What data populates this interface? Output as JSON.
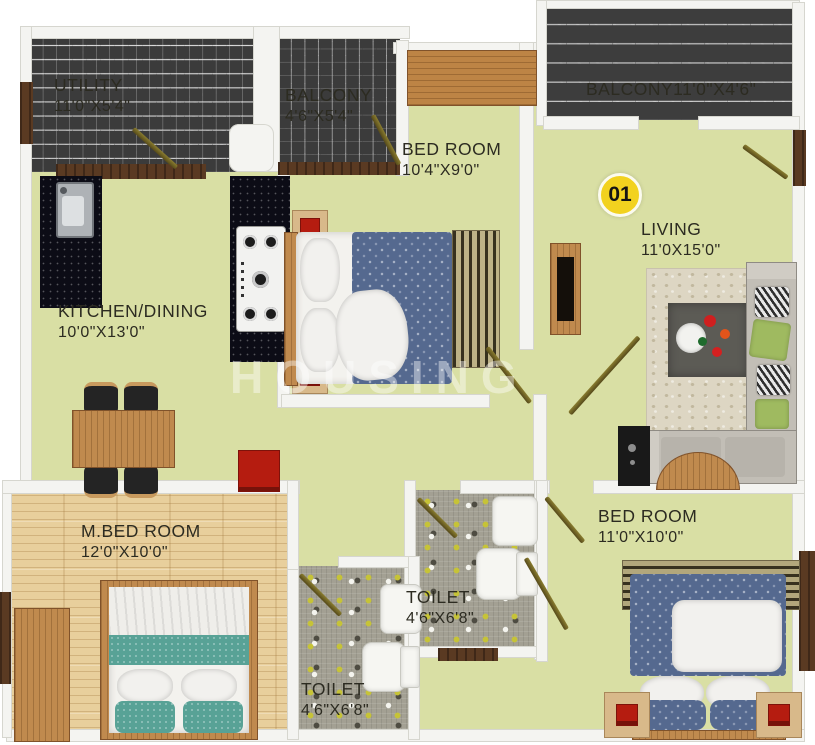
{
  "plan": {
    "badge": {
      "number": "01"
    },
    "watermark": "HOUSING",
    "rooms": {
      "utility": {
        "name": "UTILITY",
        "dims": "11'0\"X5'4\""
      },
      "balcony_top": {
        "name": "BALCONY",
        "dims": "4'6\"X5'4\""
      },
      "balcony_right": {
        "label": "BALCONY11'0\"X4'6\""
      },
      "bedroom_top": {
        "name": "BED ROOM",
        "dims": "10'4\"X9'0\""
      },
      "living": {
        "name": "LIVING",
        "dims": "11'0X15'0\""
      },
      "kitchen_dining": {
        "name": "KITCHEN/DINING",
        "dims": "10'0\"X13'0\""
      },
      "master_bedroom": {
        "name": "M.BED ROOM",
        "dims": "12'0\"X10'0\""
      },
      "toilet_middle": {
        "name": "TOILET",
        "dims": "4'6\"X6'8\""
      },
      "toilet_bottom": {
        "name": "TOILET",
        "dims": "4'6\"X6'8\""
      },
      "bedroom_bottom": {
        "name": "BED ROOM",
        "dims": "11'0\"X10'0\""
      }
    },
    "colors": {
      "floor_green": "#d9dfa4",
      "wood_floor": "#e8cf9c",
      "tile_grey": "#c4c4c4",
      "tile_dark": "#3b3b3b",
      "mosaic_grey": "#a3a093",
      "wall_white": "#f4f4f1",
      "door_olive": "#6d6322",
      "badge_yellow": "#f2d21f",
      "accent_red": "#b51c10",
      "duvet_blue": "#55698f",
      "blanket_teal": "#58a296",
      "sofa_grey": "#c2beb6",
      "label_text": "#2c2b21"
    }
  }
}
